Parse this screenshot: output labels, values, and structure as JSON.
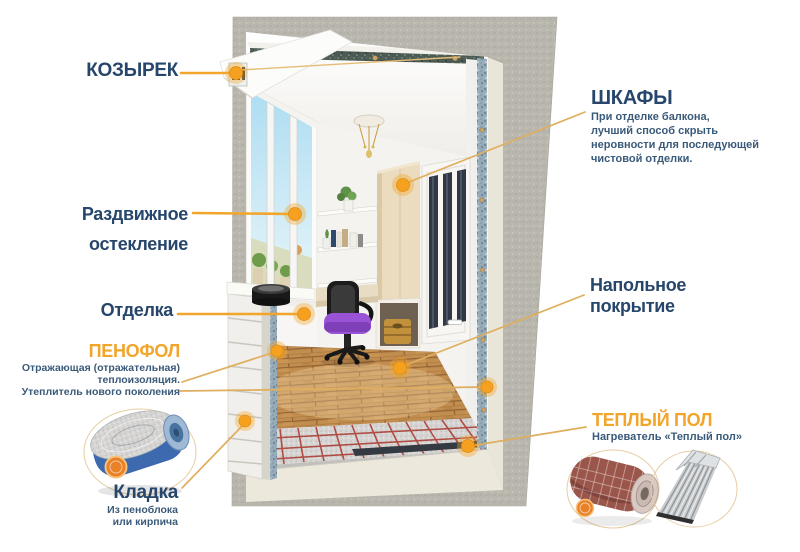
{
  "colors": {
    "accent_orange": "#F2A52B",
    "title_navy": "#27466B",
    "subtext_blue": "#3A5A7A",
    "connector_gold": "#DFAE5E",
    "wall_gray": "#B7B5AC",
    "floor_wood": "#C28E50"
  },
  "labels": {
    "kozyrek": {
      "title": "КОЗЫРЕК"
    },
    "razdvizhnoe": {
      "line1": "Раздвижное",
      "line2": "остекление"
    },
    "otdelka": {
      "title": "Отделка"
    },
    "penofol": {
      "title": "ПЕНОФОЛ",
      "desc": [
        "Отражающая (отражательная)",
        "теплоизоляция.",
        "Утеплитель нового поколения"
      ]
    },
    "kladka": {
      "title": "Кладка",
      "desc": [
        "Из пеноблока",
        "или кирпича"
      ]
    },
    "shkafy": {
      "title": "ШКАФЫ",
      "desc": [
        "При отделке балкона,",
        "лучший способ скрыть",
        "неровности для последующей",
        "чистовой отделки."
      ]
    },
    "napolnoe": {
      "line1": "Напольное",
      "line2": "покрытие"
    },
    "teply_pol": {
      "title": "ТЕПЛЫЙ ПОЛ",
      "desc": [
        "Нагреватель «Теплый пол»"
      ]
    }
  }
}
